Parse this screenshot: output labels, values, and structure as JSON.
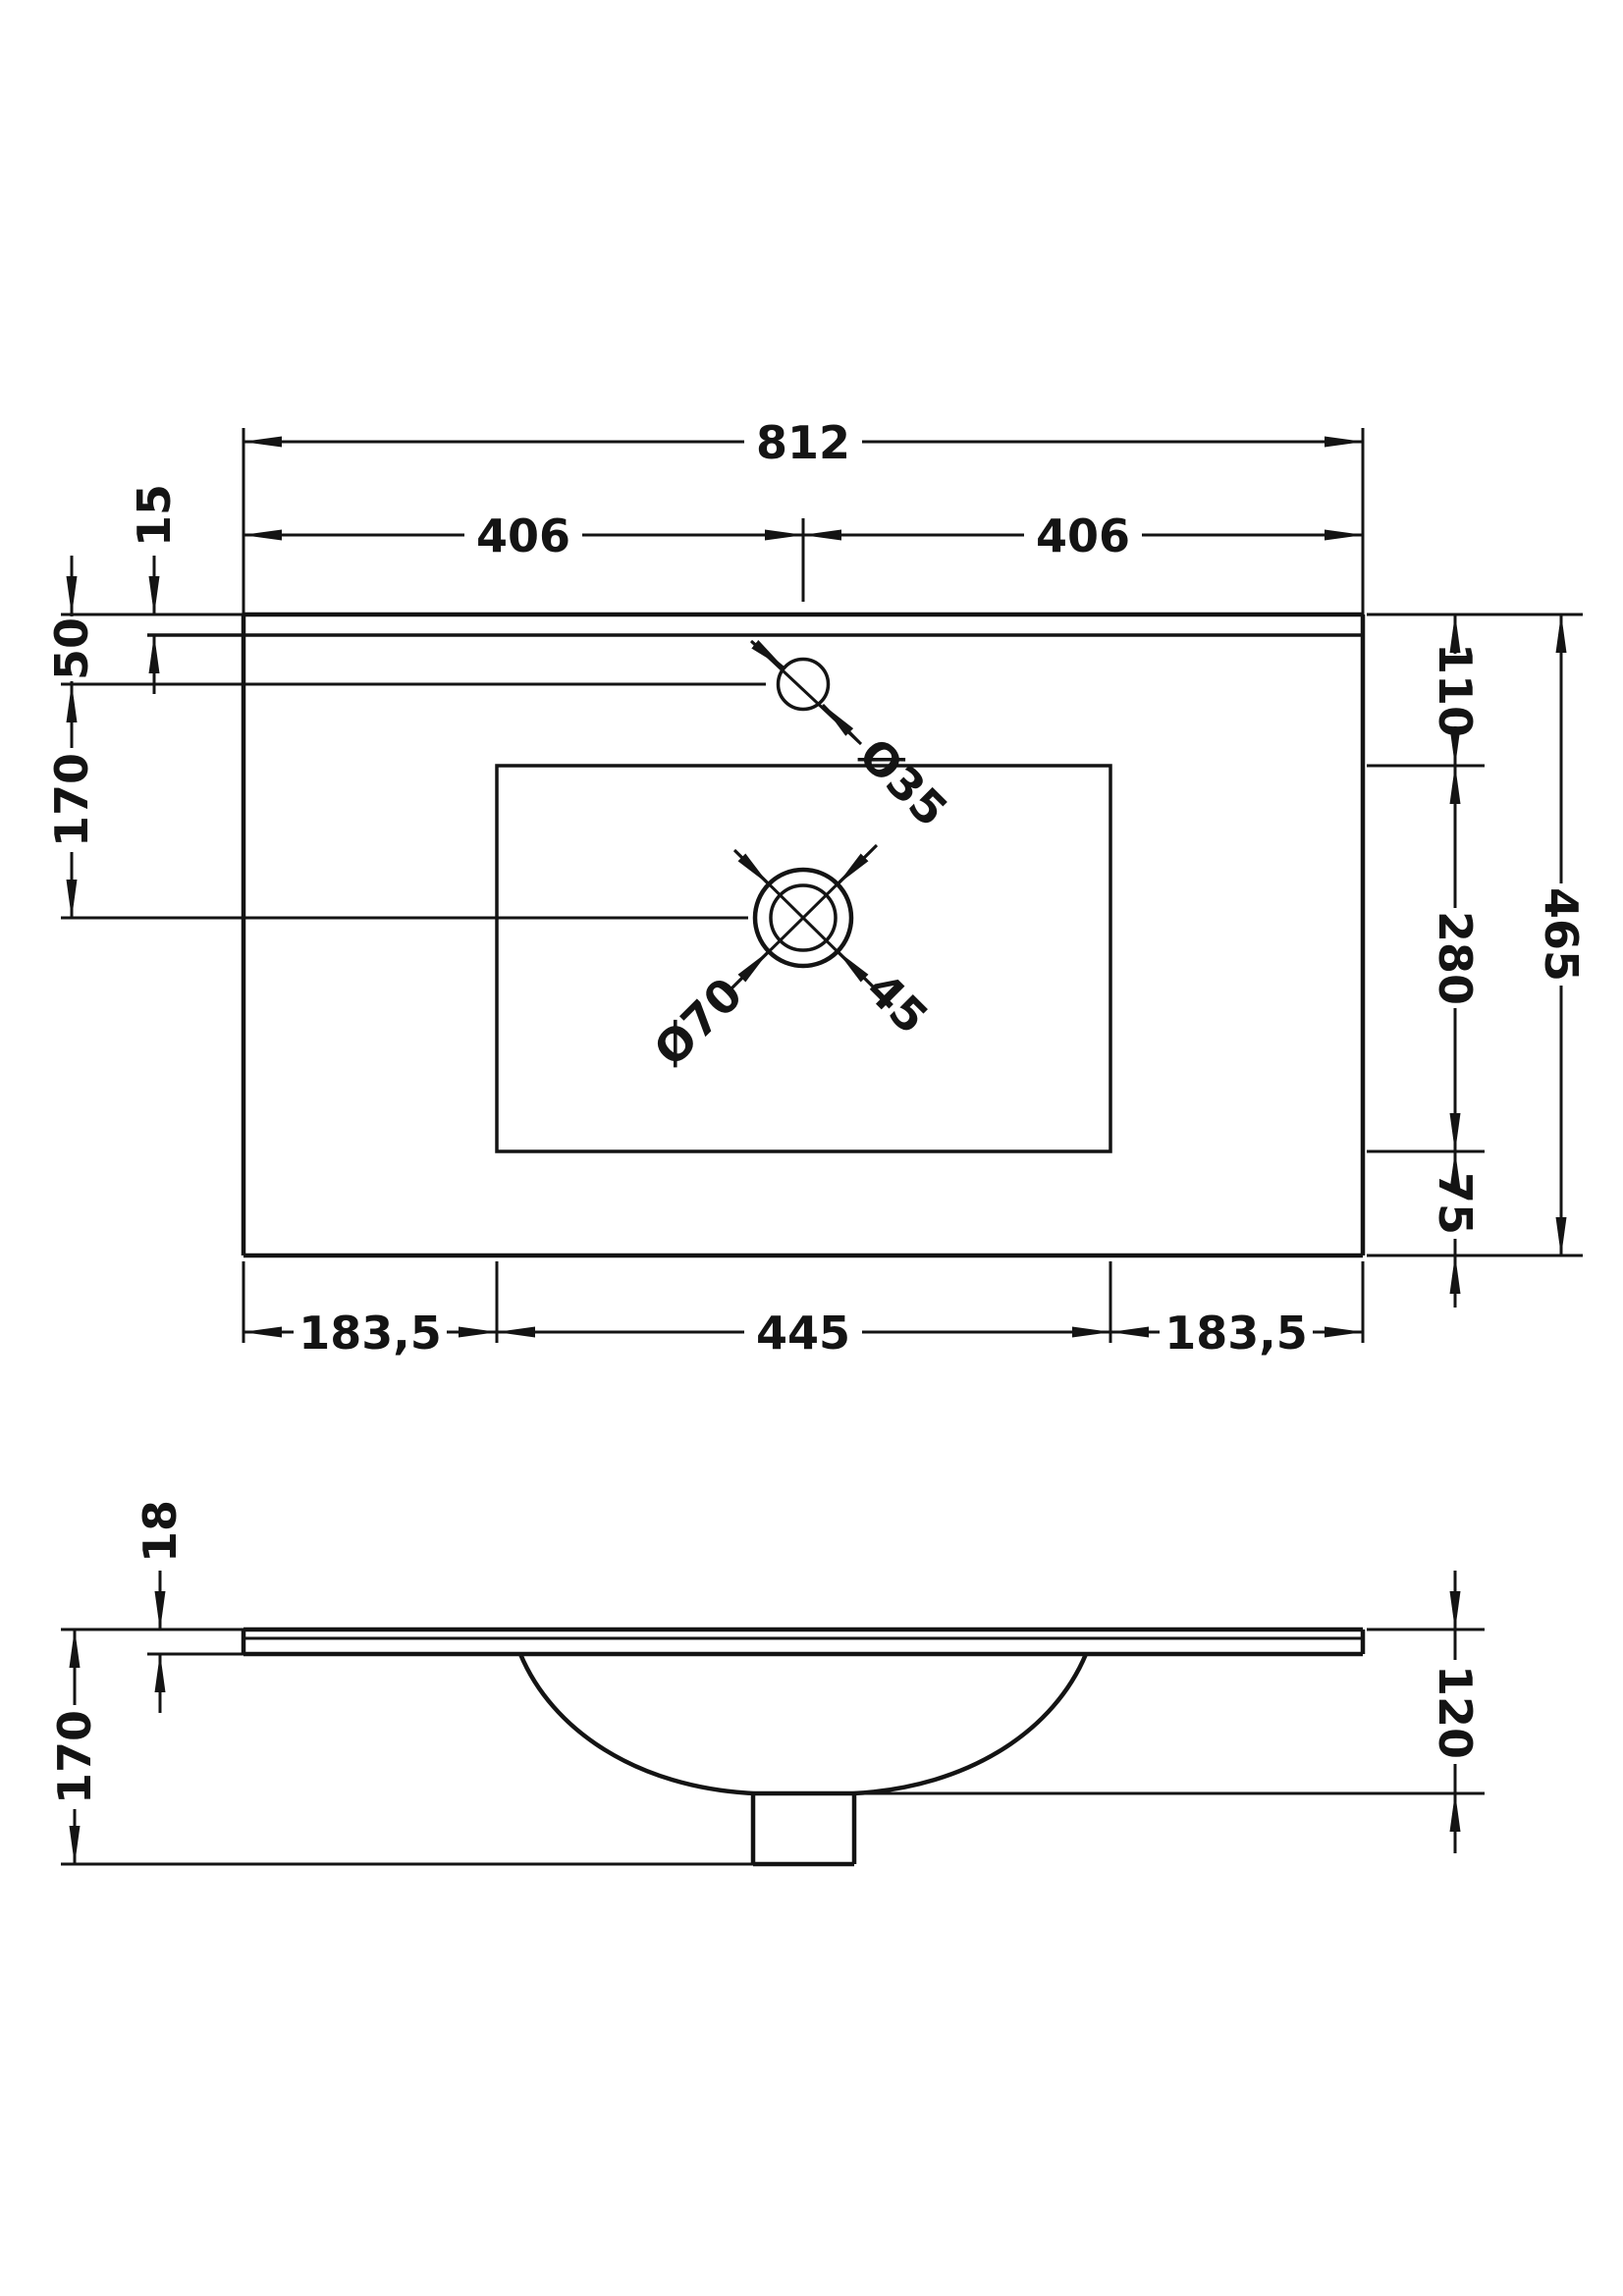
{
  "page": {
    "background": "#ffffff",
    "ink": "#141414"
  },
  "drawing": {
    "top_view": {
      "overall_width": "812",
      "half_width_left": "406",
      "half_width_right": "406",
      "rim_band": "15",
      "tap_hole_offset": "50",
      "tap_to_waste": "170",
      "tap_hole_diameter": "Ø35",
      "waste_diameter": "Ø70",
      "waste_hole": "45",
      "cutout_top_offset": "110",
      "cutout_depth": "280",
      "cutout_bottom_offset": "75",
      "overall_depth": "465",
      "cutout_left_offset": "183,5",
      "cutout_width": "445",
      "cutout_right_offset": "183,5"
    },
    "side_view": {
      "slab_thickness": "18",
      "overall_height": "170",
      "bowl_depth": "120"
    }
  }
}
